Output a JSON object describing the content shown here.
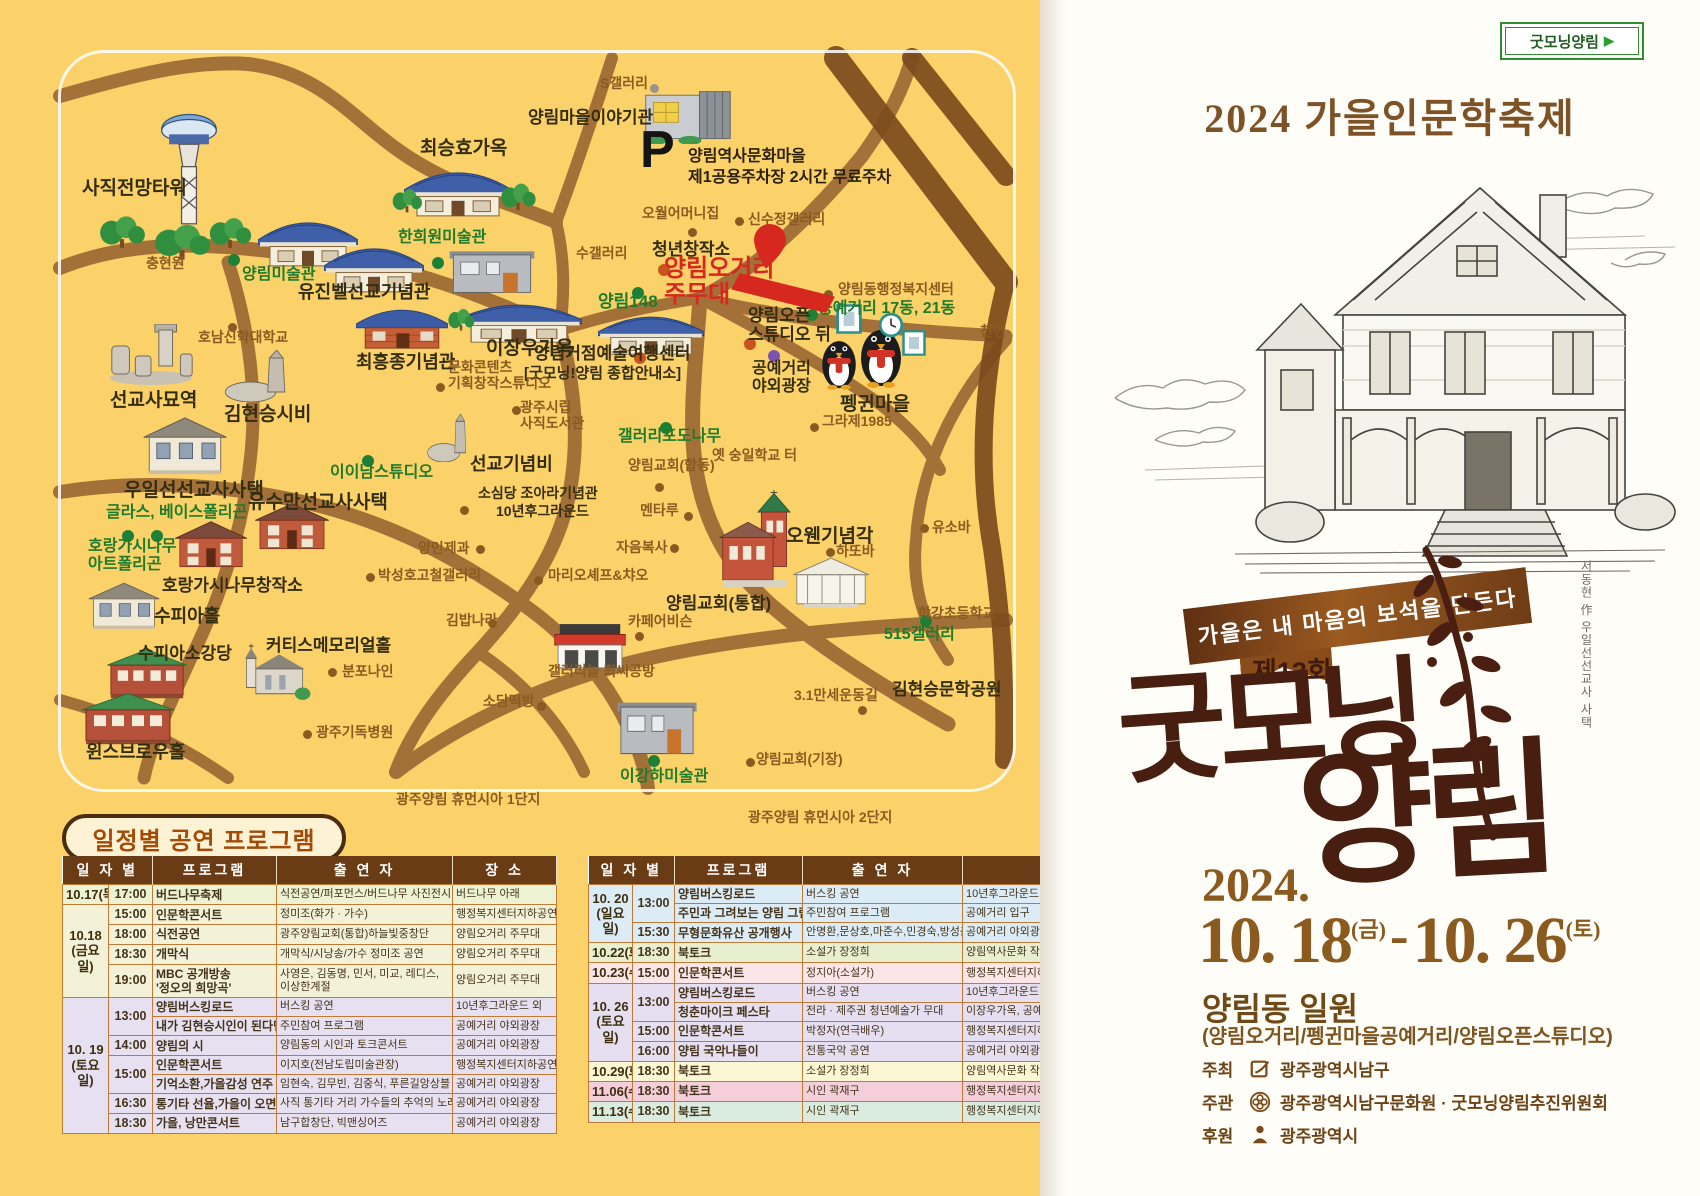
{
  "poster": {
    "badge": "굿모닝양림",
    "badge_arrow": "▶",
    "title": "2024 가을인문학축제",
    "ribbon": "가을은 내 마음의 보석을 만든다",
    "edition": "제13회",
    "calligraphy_line1": "굿모닝",
    "calligraphy_line2": "양림",
    "credit": "서동현 作 우일선선교사 사택",
    "year": "2024.",
    "date_start": "10. 18",
    "date_start_day": "(금)",
    "date_dash": "-",
    "date_end": "10. 26",
    "date_end_day": "(토)",
    "venue": "양림동 일원",
    "venue_detail": "(양림오거리/펭귄마을공예거리/양림오픈스튜디오)",
    "hosts": [
      {
        "role": "주최",
        "name": "광주광역시남구"
      },
      {
        "role": "주관",
        "name": "광주광역시남구문화원 · 굿모닝양림추진위원회"
      },
      {
        "role": "후원",
        "name": "광주광역시"
      }
    ]
  },
  "map": {
    "parking": {
      "symbol": "P",
      "line1": "양림역사문화마을",
      "line2": "제1공용주차장 2시간 무료주차"
    },
    "labels": [
      {
        "t": "양림마을이야기관",
        "x": 528,
        "y": 108,
        "c": "site"
      },
      {
        "t": "최승효가옥",
        "x": 420,
        "y": 138,
        "c": "site",
        "fs": 19
      },
      {
        "t": "사직전망타워",
        "x": 82,
        "y": 178,
        "c": "site",
        "fs": 19
      },
      {
        "t": "유진벨선교기념관",
        "x": 298,
        "y": 282,
        "c": "site",
        "fs": 18
      },
      {
        "t": "최흥종기념관",
        "x": 356,
        "y": 352,
        "c": "site",
        "fs": 18
      },
      {
        "t": "이장우가옥",
        "x": 486,
        "y": 338,
        "c": "site",
        "fs": 19
      },
      {
        "t": "선교사묘역",
        "x": 110,
        "y": 390,
        "c": "site",
        "fs": 19
      },
      {
        "t": "김현승시비",
        "x": 224,
        "y": 404,
        "c": "site",
        "fs": 19
      },
      {
        "t": "우일선선교사사택",
        "x": 124,
        "y": 480,
        "c": "site",
        "fs": 19
      },
      {
        "t": "유수만선교사사택",
        "x": 248,
        "y": 492,
        "c": "site",
        "fs": 19
      },
      {
        "t": "호랑가시나무창작소",
        "x": 162,
        "y": 576,
        "c": "site"
      },
      {
        "t": "수피아홀",
        "x": 154,
        "y": 606,
        "c": "site",
        "fs": 18
      },
      {
        "t": "수피아소강당",
        "x": 138,
        "y": 644,
        "c": "site"
      },
      {
        "t": "윈스브로우홀",
        "x": 86,
        "y": 742,
        "c": "site",
        "fs": 18
      },
      {
        "t": "커티스메모리얼홀",
        "x": 266,
        "y": 636,
        "c": "site"
      },
      {
        "t": "선교기념비",
        "x": 470,
        "y": 454,
        "c": "site",
        "fs": 18
      },
      {
        "t": "소심당 조아라기념관",
        "x": 478,
        "y": 486,
        "c": "site",
        "fs": 14
      },
      {
        "t": "10년후그라운드",
        "x": 496,
        "y": 504,
        "c": "site",
        "fs": 14
      },
      {
        "t": "양림거점예술여행센터",
        "x": 534,
        "y": 344,
        "c": "site"
      },
      {
        "t": "[굿모닝!양림 종합안내소]",
        "x": 524,
        "y": 366,
        "c": "site",
        "fs": 15
      },
      {
        "t": "청년창작소",
        "x": 652,
        "y": 240,
        "c": "site"
      },
      {
        "t": "양림오픈\n스튜디오 뒤",
        "x": 748,
        "y": 306,
        "c": "site"
      },
      {
        "t": "공예거리\n야외광장",
        "x": 752,
        "y": 360,
        "c": "site",
        "fs": 16
      },
      {
        "t": "펭귄마을",
        "x": 840,
        "y": 394,
        "c": "site",
        "fs": 19
      },
      {
        "t": "양림교회(통합)",
        "x": 666,
        "y": 594,
        "c": "site"
      },
      {
        "t": "오웬기념각",
        "x": 786,
        "y": 526,
        "c": "site",
        "fs": 19
      },
      {
        "t": "김현승문학공원",
        "x": 892,
        "y": 680,
        "c": "site"
      },
      {
        "t": "S갤러리",
        "x": 600,
        "y": 76,
        "c": "minor"
      },
      {
        "t": "충현원",
        "x": 146,
        "y": 256,
        "c": "minor"
      },
      {
        "t": "호남신학대학교",
        "x": 198,
        "y": 330,
        "c": "minor"
      },
      {
        "t": "오월어머니집",
        "x": 642,
        "y": 206,
        "c": "minor"
      },
      {
        "t": "신수정갤러리",
        "x": 748,
        "y": 212,
        "c": "minor"
      },
      {
        "t": "수갤러리",
        "x": 576,
        "y": 246,
        "c": "minor"
      },
      {
        "t": "양림동행정복지센터",
        "x": 838,
        "y": 282,
        "c": "minor"
      },
      {
        "t": "그라제1985",
        "x": 822,
        "y": 414,
        "c": "minor"
      },
      {
        "t": "옛 숭일학교 터",
        "x": 712,
        "y": 448,
        "c": "minor"
      },
      {
        "t": "양림교회(합동)",
        "x": 628,
        "y": 458,
        "c": "minor"
      },
      {
        "t": "멘타루",
        "x": 640,
        "y": 503,
        "c": "minor"
      },
      {
        "t": "자음복사",
        "x": 616,
        "y": 540,
        "c": "minor"
      },
      {
        "t": "마리오셰프&챠오",
        "x": 548,
        "y": 568,
        "c": "minor"
      },
      {
        "t": "카페어비슨",
        "x": 628,
        "y": 614,
        "c": "minor"
      },
      {
        "t": "양인제과",
        "x": 418,
        "y": 541,
        "c": "minor"
      },
      {
        "t": "박성호고철갤러리",
        "x": 378,
        "y": 568,
        "c": "minor"
      },
      {
        "t": "김밥나라",
        "x": 446,
        "y": 613,
        "c": "minor"
      },
      {
        "t": "소담떡방",
        "x": 483,
        "y": 694,
        "c": "minor"
      },
      {
        "t": "갤러리늘 최씨공방",
        "x": 548,
        "y": 664,
        "c": "minor"
      },
      {
        "t": "분포나인",
        "x": 342,
        "y": 664,
        "c": "minor"
      },
      {
        "t": "광주기독병원",
        "x": 316,
        "y": 725,
        "c": "minor"
      },
      {
        "t": "광주양림 휴먼시아 1단지",
        "x": 396,
        "y": 792,
        "c": "minor"
      },
      {
        "t": "광주양림 휴먼시아 2단지",
        "x": 748,
        "y": 810,
        "c": "minor"
      },
      {
        "t": "문화콘텐츠\n기획창작스튜디오",
        "x": 448,
        "y": 360,
        "c": "minor"
      },
      {
        "t": "광주시립\n사직도서관",
        "x": 520,
        "y": 400,
        "c": "minor"
      },
      {
        "t": "3.1만세운동길",
        "x": 794,
        "y": 688,
        "c": "minor"
      },
      {
        "t": "하또바",
        "x": 836,
        "y": 544,
        "c": "minor"
      },
      {
        "t": "유소바",
        "x": 932,
        "y": 520,
        "c": "minor"
      },
      {
        "t": "학강초등학교",
        "x": 918,
        "y": 606,
        "c": "minor"
      },
      {
        "t": "천변",
        "x": 980,
        "y": 324,
        "c": "minor"
      },
      {
        "t": "양림교회(기장)",
        "x": 756,
        "y": 752,
        "c": "minor"
      },
      {
        "t": "한희원미술관",
        "x": 398,
        "y": 229,
        "c": "green",
        "fs": 16
      },
      {
        "t": "양림미술관",
        "x": 242,
        "y": 266,
        "c": "green",
        "fs": 16
      },
      {
        "t": "양림148",
        "x": 598,
        "y": 292,
        "c": "green",
        "fs": 17
      },
      {
        "t": "공예거리 17동, 21동",
        "x": 818,
        "y": 300,
        "c": "green",
        "fs": 16
      },
      {
        "t": "갤러리포도나무",
        "x": 618,
        "y": 428,
        "c": "green",
        "fs": 16
      },
      {
        "t": "이이남스튜디오",
        "x": 330,
        "y": 464,
        "c": "green",
        "fs": 16
      },
      {
        "t": "글라스, 베이스폴리곤",
        "x": 106,
        "y": 504,
        "c": "green",
        "fs": 16
      },
      {
        "t": "호랑가시나무\n아트폴리곤",
        "x": 88,
        "y": 538,
        "c": "green",
        "fs": 16
      },
      {
        "t": "515갤러리",
        "x": 884,
        "y": 626,
        "c": "green",
        "fs": 16
      },
      {
        "t": "이강하미술관",
        "x": 620,
        "y": 768,
        "c": "green",
        "fs": 16
      },
      {
        "t": "양림오거리\n주무대",
        "x": 664,
        "y": 256,
        "c": "red"
      }
    ],
    "dots": [
      {
        "x": 228,
        "y": 254,
        "c": "g"
      },
      {
        "x": 432,
        "y": 257,
        "c": "g"
      },
      {
        "x": 632,
        "y": 287,
        "c": "g"
      },
      {
        "x": 806,
        "y": 309,
        "c": "g"
      },
      {
        "x": 660,
        "y": 422,
        "c": "g"
      },
      {
        "x": 362,
        "y": 455,
        "c": "g"
      },
      {
        "x": 122,
        "y": 530,
        "c": "g"
      },
      {
        "x": 151,
        "y": 530,
        "c": "g"
      },
      {
        "x": 920,
        "y": 615,
        "c": "g"
      },
      {
        "x": 648,
        "y": 755,
        "c": "g"
      },
      {
        "x": 658,
        "y": 264,
        "c": "o"
      },
      {
        "x": 634,
        "y": 352,
        "c": "o"
      },
      {
        "x": 744,
        "y": 338,
        "c": "o"
      },
      {
        "x": 768,
        "y": 350,
        "c": "p"
      },
      {
        "x": 688,
        "y": 228,
        "c": "b"
      },
      {
        "x": 735,
        "y": 217,
        "c": "b"
      },
      {
        "x": 228,
        "y": 323,
        "c": "b"
      },
      {
        "x": 436,
        "y": 383,
        "c": "b"
      },
      {
        "x": 512,
        "y": 406,
        "c": "b"
      },
      {
        "x": 460,
        "y": 506,
        "c": "b"
      },
      {
        "x": 476,
        "y": 545,
        "c": "b"
      },
      {
        "x": 534,
        "y": 576,
        "c": "b"
      },
      {
        "x": 670,
        "y": 544,
        "c": "b"
      },
      {
        "x": 488,
        "y": 619,
        "c": "b"
      },
      {
        "x": 635,
        "y": 632,
        "c": "b"
      },
      {
        "x": 684,
        "y": 512,
        "c": "b"
      },
      {
        "x": 655,
        "y": 483,
        "c": "b"
      },
      {
        "x": 810,
        "y": 423,
        "c": "b"
      },
      {
        "x": 824,
        "y": 290,
        "c": "b"
      },
      {
        "x": 858,
        "y": 706,
        "c": "b"
      },
      {
        "x": 826,
        "y": 548,
        "c": "b"
      },
      {
        "x": 920,
        "y": 524,
        "c": "b"
      },
      {
        "x": 303,
        "y": 730,
        "c": "b"
      },
      {
        "x": 328,
        "y": 668,
        "c": "b"
      },
      {
        "x": 537,
        "y": 702,
        "c": "b"
      },
      {
        "x": 366,
        "y": 573,
        "c": "b"
      },
      {
        "x": 746,
        "y": 758,
        "c": "b"
      },
      {
        "x": 650,
        "y": 84,
        "c": "gr"
      }
    ],
    "buildings": [
      {
        "k": "tower",
        "x": 146,
        "y": 112,
        "w": 86,
        "h": 118
      },
      {
        "k": "tree",
        "x": 96,
        "y": 212,
        "w": 52,
        "h": 38
      },
      {
        "k": "tree",
        "x": 150,
        "y": 220,
        "w": 64,
        "h": 42
      },
      {
        "k": "tree",
        "x": 206,
        "y": 214,
        "w": 48,
        "h": 36
      },
      {
        "k": "hanok",
        "x": 404,
        "y": 160,
        "w": 108,
        "h": 58
      },
      {
        "k": "tree",
        "x": 390,
        "y": 186,
        "w": 34,
        "h": 28
      },
      {
        "k": "tree",
        "x": 498,
        "y": 180,
        "w": 40,
        "h": 32
      },
      {
        "k": "hanok",
        "x": 258,
        "y": 210,
        "w": 100,
        "h": 58
      },
      {
        "k": "hanok",
        "x": 324,
        "y": 236,
        "w": 100,
        "h": 58
      },
      {
        "k": "gray2",
        "x": 446,
        "y": 246,
        "w": 92,
        "h": 50
      },
      {
        "k": "modern",
        "x": 640,
        "y": 88,
        "w": 96,
        "h": 56
      },
      {
        "k": "brick",
        "x": 356,
        "y": 300,
        "w": 92,
        "h": 50
      },
      {
        "k": "hanok",
        "x": 456,
        "y": 294,
        "w": 126,
        "h": 50
      },
      {
        "k": "tree",
        "x": 446,
        "y": 306,
        "w": 30,
        "h": 26
      },
      {
        "k": "hanok",
        "x": 598,
        "y": 306,
        "w": 106,
        "h": 50
      },
      {
        "k": "stones",
        "x": 102,
        "y": 324,
        "w": 98,
        "h": 62
      },
      {
        "k": "monument",
        "x": 220,
        "y": 350,
        "w": 90,
        "h": 52
      },
      {
        "k": "monument",
        "x": 424,
        "y": 414,
        "w": 58,
        "h": 48
      },
      {
        "k": "western",
        "x": 138,
        "y": 414,
        "w": 94,
        "h": 64
      },
      {
        "k": "brick2",
        "x": 252,
        "y": 502,
        "w": 80,
        "h": 50
      },
      {
        "k": "brick2",
        "x": 172,
        "y": 520,
        "w": 78,
        "h": 50
      },
      {
        "k": "western",
        "x": 84,
        "y": 580,
        "w": 80,
        "h": 52
      },
      {
        "k": "brickgreen",
        "x": 104,
        "y": 646,
        "w": 86,
        "h": 54
      },
      {
        "k": "brickgreen",
        "x": 78,
        "y": 690,
        "w": 100,
        "h": 56
      },
      {
        "k": "church",
        "x": 234,
        "y": 644,
        "w": 78,
        "h": 58
      },
      {
        "k": "redchurch",
        "x": 716,
        "y": 490,
        "w": 84,
        "h": 102
      },
      {
        "k": "classic",
        "x": 786,
        "y": 554,
        "w": 90,
        "h": 54
      },
      {
        "k": "shop",
        "x": 548,
        "y": 622,
        "w": 84,
        "h": 48
      },
      {
        "k": "gray2",
        "x": 614,
        "y": 696,
        "w": 86,
        "h": 62
      },
      {
        "k": "penguin",
        "x": 818,
        "y": 336,
        "w": 42,
        "h": 54
      },
      {
        "k": "penguin",
        "x": 856,
        "y": 324,
        "w": 50,
        "h": 64
      },
      {
        "k": "frame",
        "x": 836,
        "y": 304,
        "w": 26,
        "h": 30
      },
      {
        "k": "clock",
        "x": 878,
        "y": 312,
        "w": 26,
        "h": 26
      },
      {
        "k": "frame",
        "x": 902,
        "y": 330,
        "w": 24,
        "h": 26
      }
    ]
  },
  "schedule": {
    "section_title": "일정별 공연 프로그램",
    "tables": [
      {
        "headers": [
          "일 자 별",
          "프로그램",
          "출 연 자",
          "장 소"
        ],
        "rows": [
          {
            "date": "10.17(목)",
            "dateRs": 1,
            "time": "17:00",
            "prog": "버드나무축제",
            "cast": "식전공연/퍼포먼스/버드나무 사진전시",
            "place": "버드나무 아래",
            "bg": "a"
          },
          {
            "date": "10.18\n(금요일)",
            "dateRs": 4,
            "time": "15:00",
            "prog": "인문학콘서트",
            "cast": "정미조(화가 · 가수)",
            "place": "행정복지센터지하공연장",
            "bg": "b"
          },
          {
            "time": "18:00",
            "prog": "식전공연",
            "cast": "광주양림교회(통합)하늘빛중창단",
            "place": "양림오거리 주무대",
            "bg": "b"
          },
          {
            "time": "18:30",
            "prog": "개막식",
            "cast": "개막식/시낭송/가수 정미조 공연",
            "place": "양림오거리 주무대",
            "bg": "b"
          },
          {
            "time": "19:00",
            "prog": "MBC 공개방송\n'정오의 희망곡'",
            "cast": "사영은, 김동명, 민서, 미교, 레디스,\n이상한계절",
            "place": "양림오거리 주무대",
            "bg": "b"
          },
          {
            "date": "10. 19\n(토요일)",
            "dateRs": 7,
            "time": "13:00",
            "timeRs": 2,
            "prog": "양림버스킹로드",
            "cast": "버스킹 공연",
            "place": "10년후그라운드 외",
            "bg": "c"
          },
          {
            "prog": "내가 김현승시인이 된다면",
            "cast": "주민참여 프로그램",
            "place": "공예거리 야외광장",
            "bg": "c"
          },
          {
            "time": "14:00",
            "prog": "양림의 시",
            "cast": "양림동의 시인과 토크콘서트",
            "place": "공예거리 야외광장",
            "bg": "c"
          },
          {
            "time": "15:00",
            "timeRs": 2,
            "prog": "인문학콘서트",
            "cast": "이지호(전남도립미술관장)",
            "place": "행정복지센터지하공연장",
            "bg": "c"
          },
          {
            "prog": "기억소환,가을감성 연주",
            "cast": "임현숙, 김무빈, 김중식, 푸른길앙상블",
            "place": "공예거리 야외광장",
            "bg": "c"
          },
          {
            "time": "16:30",
            "prog": "통기타 선율,가을이 오면",
            "cast": "사직 통기타 거리 가수들의 추억의 노래",
            "place": "공예거리 야외광장",
            "bg": "c"
          },
          {
            "time": "18:30",
            "prog": "가을, 낭만콘서트",
            "cast": "남구합창단, 빅맨싱어즈",
            "place": "공예거리 야외광장",
            "bg": "c"
          }
        ]
      },
      {
        "headers": [
          "일 자 별",
          "프로그램",
          "출 연 자",
          ""
        ],
        "rows": [
          {
            "date": "10. 20\n(일요일)",
            "dateRs": 3,
            "time": "13:00",
            "timeRs": 2,
            "prog": "양림버스킹로드",
            "cast": "버스킹 공연",
            "place": "10년후그라운드 외",
            "bg": "blue"
          },
          {
            "prog": "주민과 그려보는 양림 그림여행",
            "cast": "주민참여 프로그램",
            "place": "공예거리 입구",
            "bg": "blue"
          },
          {
            "time": "15:30",
            "prog": "무형문화유산 공개행사",
            "cast": "안명환,문상호,마준수,민경숙,방성춘,황승옥",
            "place": "공예거리 야외광장",
            "bg": "blue"
          },
          {
            "date": "10.22(화)",
            "time": "18:30",
            "prog": "북토크",
            "cast": "소설가 장정희",
            "place": "양림역사문화 작은도서관",
            "bg": "green"
          },
          {
            "date": "10.23(수)",
            "time": "15:00",
            "prog": "인문학콘서트",
            "cast": "정지아(소설가)",
            "place": "행정복지센터지하공연장",
            "bg": "pink"
          },
          {
            "date": "10. 26\n(토요일)",
            "dateRs": 4,
            "time": "13:00",
            "timeRs": 2,
            "prog": "양림버스킹로드",
            "cast": "버스킹 공연",
            "place": "10년후그라운드 외",
            "bg": "purple"
          },
          {
            "prog": "청춘마이크 페스타",
            "cast": "전라 · 제주권 청년예술가 무대",
            "place": "이장우가옥, 공예거리 외",
            "bg": "purple"
          },
          {
            "time": "15:00",
            "prog": "인문학콘서트",
            "cast": "박정자(연극배우)",
            "place": "행정복지센터지하공연장",
            "bg": "purple"
          },
          {
            "time": "16:00",
            "prog": "양림 국악나들이",
            "cast": "전통국악 공연",
            "place": "공예거리 야외광장",
            "bg": "purple"
          },
          {
            "date": "10.29(화)",
            "time": "18:30",
            "prog": "북토크",
            "cast": "소설가 장정희",
            "place": "양림역사문화 작은도서관",
            "bg": "yellow"
          },
          {
            "date": "11.06(수)",
            "time": "18:30",
            "prog": "북토크",
            "cast": "시인 곽재구",
            "place": "행정복지센터지하공연장",
            "bg": "rose"
          },
          {
            "date": "11.13(수)",
            "time": "18:30",
            "prog": "북토크",
            "cast": "시인 곽재구",
            "place": "행정복지센터지하공연장",
            "bg": "mint"
          }
        ]
      }
    ]
  },
  "colors": {
    "panel_yellow": "#fbd169",
    "road": "#a06e37",
    "road_dark": "#7b4b1d",
    "accent_red": "#d6281e",
    "accent_green": "#1d7c2b",
    "label_brown": "#8a5a20",
    "table_header": "#6a3c15",
    "calligraphy": "#471e10",
    "poster_brown": "#8a5a1f"
  }
}
